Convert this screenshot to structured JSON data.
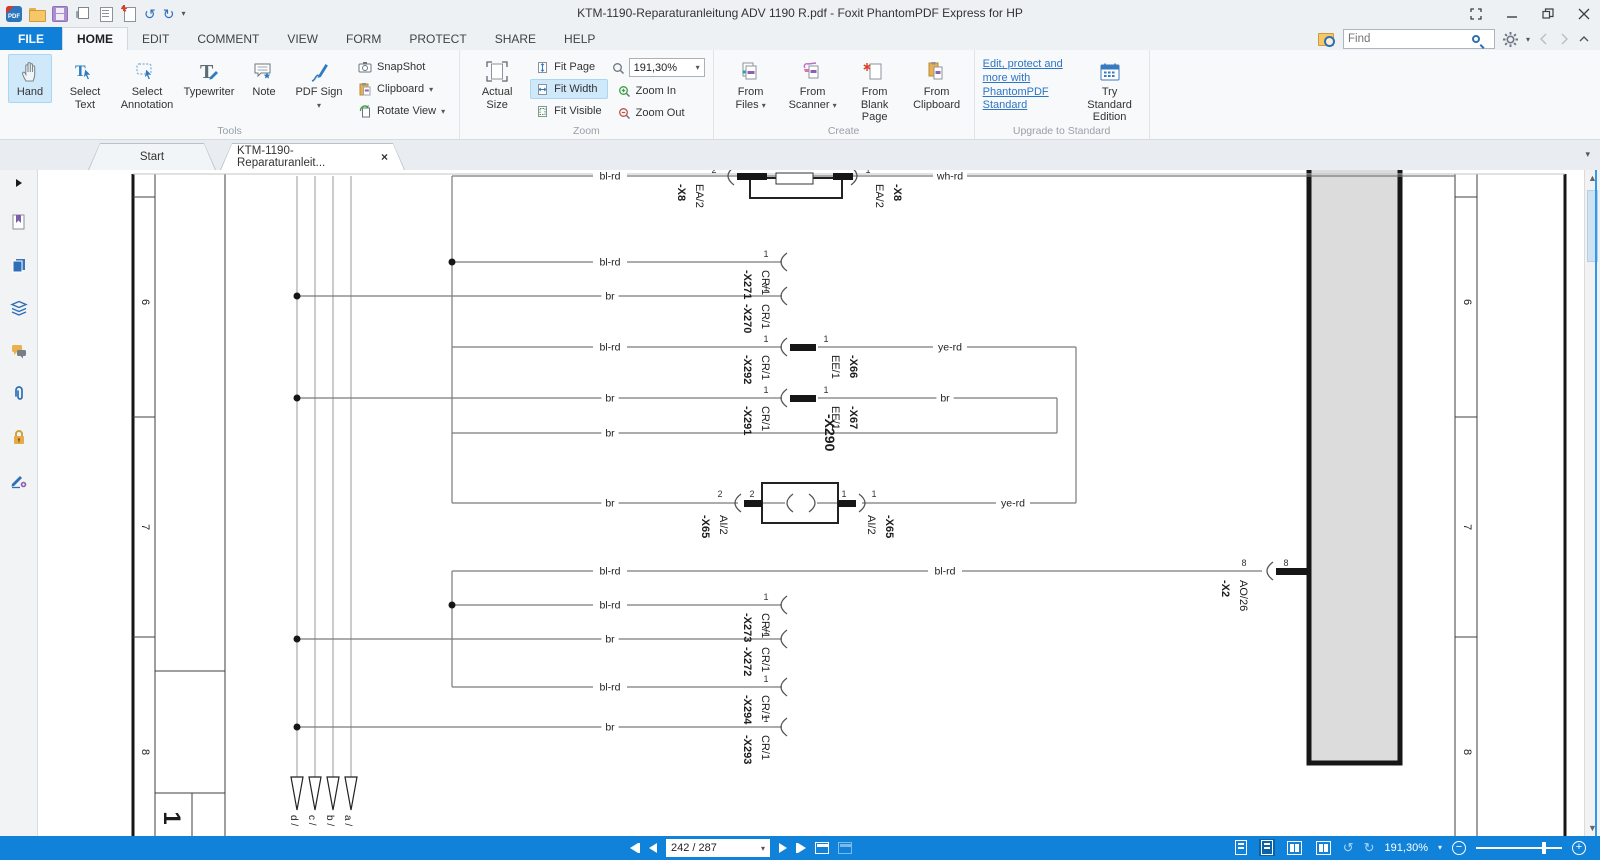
{
  "titlebar": {
    "title": "KTM-1190-Reparaturanleitung ADV 1190 R.pdf - Foxit PhantomPDF Express for HP"
  },
  "menu": {
    "items": [
      "FILE",
      "HOME",
      "EDIT",
      "COMMENT",
      "VIEW",
      "FORM",
      "PROTECT",
      "SHARE",
      "HELP"
    ]
  },
  "find": {
    "placeholder": "Find"
  },
  "ribbon": {
    "tools": {
      "label": "Tools",
      "big": [
        {
          "label": "Hand"
        },
        {
          "label": "Select Text"
        },
        {
          "label": "Select Annotation"
        },
        {
          "label": "Typewriter"
        },
        {
          "label": "Note"
        },
        {
          "label": "PDF Sign"
        }
      ],
      "small": [
        {
          "label": "SnapShot"
        },
        {
          "label": "Clipboard"
        },
        {
          "label": "Rotate View"
        }
      ]
    },
    "zoom": {
      "label": "Zoom",
      "actual": "Actual Size",
      "fit": [
        "Fit Page",
        "Fit Width",
        "Fit Visible"
      ],
      "value": "191,30%",
      "zin": "Zoom In",
      "zout": "Zoom Out"
    },
    "create": {
      "label": "Create",
      "items": [
        "From Files",
        "From Scanner",
        "From Blank Page",
        "From Clipboard"
      ]
    },
    "upgrade": {
      "label": "Upgrade to Standard",
      "link": "Edit, protect and more with PhantomPDF Standard",
      "button": "Try Standard Edition"
    }
  },
  "doctabs": {
    "start": "Start",
    "doc": "KTM-1190-Reparaturanleit..."
  },
  "sidebar_icons": [
    "expand-arrow",
    "bookmarks",
    "page-thumbnails",
    "layers",
    "comments",
    "attachments",
    "security",
    "digital-signatures"
  ],
  "status": {
    "page": "242 / 287",
    "zoom": "191,30%"
  },
  "diagram": {
    "lines": [
      [
        95,
        4,
        95,
        666,
        "F"
      ],
      [
        117,
        4,
        117,
        666,
        "f"
      ],
      [
        95,
        27,
        117,
        27,
        "f"
      ],
      [
        95,
        247,
        117,
        247,
        "f"
      ],
      [
        95,
        467,
        117,
        467,
        "f"
      ],
      [
        187,
        4,
        187,
        666,
        "f"
      ],
      [
        117,
        501,
        187,
        501,
        "f"
      ],
      [
        117,
        623,
        187,
        623,
        "f"
      ],
      [
        154,
        623,
        154,
        666,
        "f"
      ],
      [
        1417,
        4,
        1417,
        666,
        "f"
      ],
      [
        1439,
        4,
        1439,
        666,
        "f"
      ],
      [
        1417,
        27,
        1439,
        27,
        "f"
      ],
      [
        1417,
        247,
        1439,
        247,
        "f"
      ],
      [
        1417,
        467,
        1439,
        467,
        "f"
      ],
      [
        1527,
        4,
        1527,
        666,
        "F"
      ],
      [
        95,
        4,
        1527,
        4,
        "b"
      ],
      [
        259,
        6,
        259,
        607,
        "u"
      ],
      [
        277,
        6,
        277,
        607,
        "u"
      ],
      [
        295,
        6,
        295,
        607,
        "u"
      ],
      [
        313,
        6,
        313,
        607,
        "u"
      ],
      [
        414,
        6,
        1417,
        6,
        "w"
      ],
      [
        414,
        6,
        414,
        333,
        "w"
      ],
      [
        414,
        92,
        744,
        92,
        "w"
      ],
      [
        259,
        126,
        744,
        126,
        "w"
      ],
      [
        414,
        177,
        744,
        177,
        "w"
      ],
      [
        780,
        177,
        1038,
        177,
        "w"
      ],
      [
        1038,
        177,
        1038,
        333,
        "w"
      ],
      [
        259,
        228,
        744,
        228,
        "w"
      ],
      [
        780,
        228,
        1019,
        228,
        "w"
      ],
      [
        1019,
        228,
        1019,
        263,
        "w"
      ],
      [
        414,
        263,
        1019,
        263,
        "w"
      ],
      [
        414,
        333,
        700,
        333,
        "w"
      ],
      [
        724,
        333,
        747,
        333,
        "w"
      ],
      [
        779,
        333,
        800,
        333,
        "w"
      ],
      [
        824,
        333,
        1038,
        333,
        "w"
      ],
      [
        414,
        401,
        1224,
        401,
        "w"
      ],
      [
        414,
        401,
        414,
        517,
        "w"
      ],
      [
        414,
        435,
        744,
        435,
        "w"
      ],
      [
        259,
        469,
        744,
        469,
        "w"
      ],
      [
        414,
        517,
        744,
        517,
        "w"
      ],
      [
        259,
        557,
        744,
        557,
        "w"
      ]
    ],
    "rects": [
      [
        "e",
        1271,
        -8,
        91,
        601
      ],
      [
        "O",
        712,
        8,
        92,
        20
      ],
      [
        "o",
        738,
        3,
        37,
        11
      ],
      [
        "k",
        699,
        3,
        30,
        7
      ],
      [
        "k",
        795,
        3,
        20,
        7
      ],
      [
        "O",
        724,
        313,
        76,
        40
      ],
      [
        "k",
        706,
        330,
        18,
        7
      ],
      [
        "k",
        800,
        330,
        18,
        7
      ],
      [
        "k",
        752,
        174,
        26,
        7
      ],
      [
        "k",
        752,
        225,
        26,
        7
      ],
      [
        "k",
        1238,
        398,
        33,
        7
      ]
    ],
    "arcs": [
      [
        691,
        6,
        1
      ],
      [
        818,
        6,
        -1
      ],
      [
        744,
        92,
        1
      ],
      [
        744,
        126,
        1
      ],
      [
        744,
        177,
        1
      ],
      [
        744,
        228,
        1
      ],
      [
        698,
        333,
        1
      ],
      [
        750,
        333,
        1
      ],
      [
        776,
        333,
        -1
      ],
      [
        826,
        333,
        -1
      ],
      [
        744,
        435,
        1
      ],
      [
        744,
        469,
        1
      ],
      [
        744,
        517,
        1
      ],
      [
        744,
        557,
        1
      ],
      [
        1230,
        401,
        1
      ]
    ],
    "dots": [
      [
        414,
        92
      ],
      [
        259,
        126
      ],
      [
        259,
        228
      ],
      [
        414,
        435
      ],
      [
        259,
        469
      ],
      [
        259,
        557
      ]
    ],
    "arrow_y": 607,
    "arrows": [
      {
        "x": 259,
        "label": "d /"
      },
      {
        "x": 277,
        "label": "c /"
      },
      {
        "x": 295,
        "label": "b /"
      },
      {
        "x": 313,
        "label": "a /"
      }
    ],
    "wire_labels": [
      [
        "bl-rd",
        572,
        6
      ],
      [
        "wh-rd",
        912,
        6
      ],
      [
        "bl-rd",
        572,
        92
      ],
      [
        "br",
        572,
        126
      ],
      [
        "bl-rd",
        572,
        177
      ],
      [
        "ye-rd",
        912,
        177
      ],
      [
        "br",
        572,
        228
      ],
      [
        "br",
        907,
        228
      ],
      [
        "br",
        572,
        263
      ],
      [
        "br",
        572,
        333
      ],
      [
        "ye-rd",
        975,
        333
      ],
      [
        "bl-rd",
        572,
        401
      ],
      [
        "bl-rd",
        907,
        401
      ],
      [
        "bl-rd",
        572,
        435
      ],
      [
        "br",
        572,
        469
      ],
      [
        "bl-rd",
        572,
        517
      ],
      [
        "br",
        572,
        557
      ]
    ],
    "pins": [
      [
        "2",
        676,
        3
      ],
      [
        "1",
        830,
        3
      ],
      [
        "1",
        728,
        87
      ],
      [
        "1",
        728,
        121
      ],
      [
        "1",
        728,
        172
      ],
      [
        "1",
        788,
        172
      ],
      [
        "1",
        728,
        223
      ],
      [
        "1",
        788,
        223
      ],
      [
        "2",
        682,
        327
      ],
      [
        "2",
        714,
        327
      ],
      [
        "1",
        806,
        327
      ],
      [
        "1",
        836,
        327
      ],
      [
        "1",
        728,
        430
      ],
      [
        "1",
        728,
        464
      ],
      [
        "1",
        728,
        512
      ],
      [
        "1",
        728,
        552
      ],
      [
        "8",
        1206,
        396
      ],
      [
        "8",
        1248,
        396
      ]
    ],
    "labels": [
      {
        "t": "-X8",
        "x": 640,
        "y": 14,
        "b": 1
      },
      {
        "t": "EA/2",
        "x": 658,
        "y": 14
      },
      {
        "t": "EA/2",
        "x": 838,
        "y": 14
      },
      {
        "t": "-X8",
        "x": 856,
        "y": 14,
        "b": 1
      },
      {
        "t": "-X271",
        "x": 706,
        "y": 100,
        "b": 1
      },
      {
        "t": "CR/1",
        "x": 724,
        "y": 100
      },
      {
        "t": "-X270",
        "x": 706,
        "y": 134,
        "b": 1
      },
      {
        "t": "CR/1",
        "x": 724,
        "y": 134
      },
      {
        "t": "-X292",
        "x": 706,
        "y": 185,
        "b": 1
      },
      {
        "t": "CR/1",
        "x": 724,
        "y": 185
      },
      {
        "t": "EE/1",
        "x": 794,
        "y": 185
      },
      {
        "t": "-X66",
        "x": 812,
        "y": 185,
        "b": 1
      },
      {
        "t": "-X291",
        "x": 706,
        "y": 236,
        "b": 1
      },
      {
        "t": "CR/1",
        "x": 724,
        "y": 236
      },
      {
        "t": "EE/1",
        "x": 794,
        "y": 236
      },
      {
        "t": "-X67",
        "x": 812,
        "y": 236,
        "b": 1
      },
      {
        "t": "-X290",
        "x": 787,
        "y": 244,
        "b": 1,
        "s": 14
      },
      {
        "t": "-X65",
        "x": 664,
        "y": 345,
        "b": 1
      },
      {
        "t": "AI/2",
        "x": 682,
        "y": 345
      },
      {
        "t": "AI/2",
        "x": 830,
        "y": 345
      },
      {
        "t": "-X65",
        "x": 848,
        "y": 345,
        "b": 1
      },
      {
        "t": "-X273",
        "x": 706,
        "y": 443,
        "b": 1
      },
      {
        "t": "CR/1",
        "x": 724,
        "y": 443
      },
      {
        "t": "-X272",
        "x": 706,
        "y": 477,
        "b": 1
      },
      {
        "t": "CR/1",
        "x": 724,
        "y": 477
      },
      {
        "t": "-X294",
        "x": 706,
        "y": 525,
        "b": 1
      },
      {
        "t": "CR/1",
        "x": 724,
        "y": 525
      },
      {
        "t": "-X293",
        "x": 706,
        "y": 565,
        "b": 1
      },
      {
        "t": "CR/1",
        "x": 724,
        "y": 565
      },
      {
        "t": "-X2",
        "x": 1184,
        "y": 410,
        "b": 1
      },
      {
        "t": "AO/26",
        "x": 1202,
        "y": 410
      },
      {
        "t": "6",
        "x": 104,
        "y": 132,
        "m": 1
      },
      {
        "t": "7",
        "x": 104,
        "y": 357,
        "m": 1
      },
      {
        "t": "8",
        "x": 104,
        "y": 582,
        "m": 1
      },
      {
        "t": "6",
        "x": 1426,
        "y": 132,
        "m": 1
      },
      {
        "t": "7",
        "x": 1426,
        "y": 357,
        "m": 1
      },
      {
        "t": "8",
        "x": 1426,
        "y": 582,
        "m": 1
      },
      {
        "t": "1",
        "x": 126,
        "y": 648,
        "b": 1,
        "m": 1,
        "s": 24
      }
    ]
  }
}
